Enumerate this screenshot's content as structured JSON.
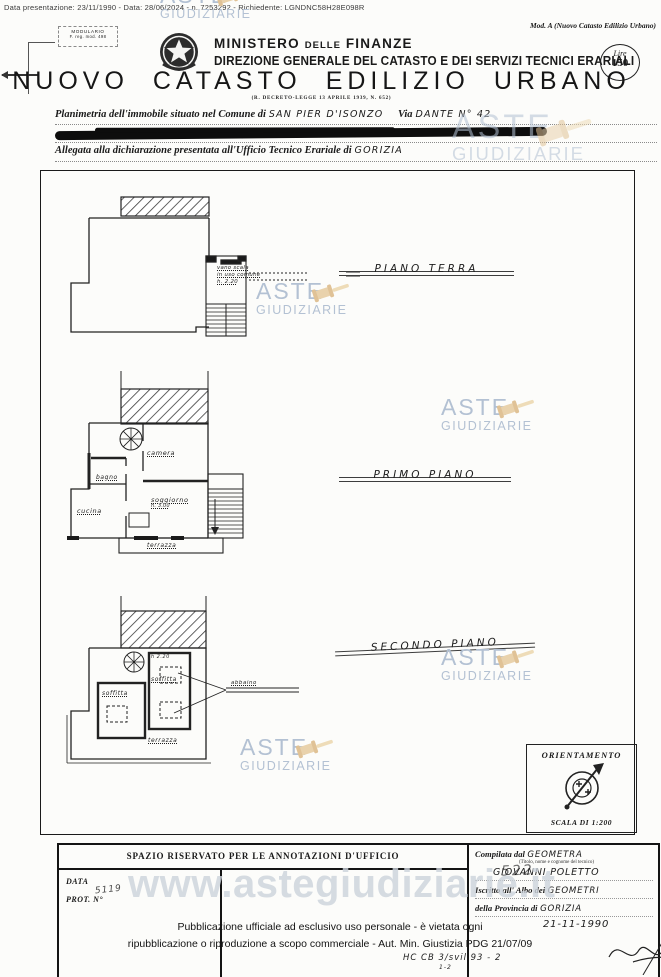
{
  "page": {
    "meta_line": "Data presentazione: 23/11/1990 - Data: 28/06/2024 - n. 7253292 - Richiedente: LGNDNC58H28E098R",
    "mod_ref": "Mod. A (Nuovo Catasto Edilizio Urbano)",
    "modulario": {
      "line1": "MODULARIO",
      "line2": "F. reg. mod. 498"
    },
    "ministry_1": "MINISTERO",
    "ministry_2": "DELLE",
    "ministry_3": "FINANZE",
    "directorate": "DIREZIONE GENERALE DEL CATASTO E DEI SERVIZI TECNICI ERARIALI",
    "stamp": {
      "currency": "Lire",
      "amount": "150"
    },
    "title": "NUOVO CATASTO EDILIZIO URBANO",
    "law_ref": "(R. DECRETO-LEGGE 13 APRILE 1939, N. 652)"
  },
  "form": {
    "field1_label": "Planimetria dell'immobile situato nel Comune di",
    "field1_value": "San Pier d'Isonzo",
    "field1b_label": "Via",
    "field1b_value": "Dante n° 42",
    "field3_label": "Allegata alla dichiarazione presentata all'Ufficio Tecnico Erariale di",
    "field3_value": "Gorizia"
  },
  "plans": {
    "ground": {
      "label": "PIANO TERRA",
      "note1": "vano scala",
      "note2": "in uso comune",
      "note3": "h. 2.20"
    },
    "first": {
      "label": "PRIMO PIANO",
      "camera": "camera",
      "bagno": "bagno",
      "cucina": "cucina",
      "soggiorno": "soggiorno",
      "soggiorno_h": "h. 3.00",
      "terrazza": "terrazza"
    },
    "second": {
      "label": "SECONDO PIANO",
      "soffitta1": "soffitta",
      "soffitta2": "soffitta",
      "h_note": "h 2.20",
      "abbaino": "abbaino",
      "terrazza": "terrazza"
    },
    "sheet_number": "522",
    "code_note": "HC CB 3/svil 93 - 2",
    "code_note_sub": "1-2",
    "orientation": {
      "title": "ORIENTAMENTO",
      "scale": "SCALA DI 1:200"
    }
  },
  "footer": {
    "annotations_header": "SPAZIO RISERVATO PER LE ANNOTAZIONI D'UFFICIO",
    "data_label": "DATA",
    "prot_label": "PROT. N°",
    "prot_value": "5119",
    "compiled_label": "Compilata dal",
    "compiled_value": "GEOMETRA",
    "compiled_hint": "(Titolo, nome e cognome del tecnico)",
    "technician_name": "GIOVANNI POLETTO",
    "albo_label": "Iscritto all' Albo dei",
    "albo_value": "GEOMETRI",
    "province_label": "della Provincia di",
    "province_value": "GORIZIA",
    "date_value": "21-11-1990"
  },
  "watermarks": {
    "aste_line1": "ASTE",
    "aste_line2": "GIUDIZIARIE",
    "site_url": "www.astegiudiziarie.it"
  },
  "legal": {
    "line1": "Pubblicazione ufficiale ad esclusivo uso personale - è vietata ogni",
    "line2": "ripubblicazione o riproduzione a scopo commerciale - Aut. Min. Giustizia PDG 21/07/09"
  },
  "colors": {
    "watermark_text": "#b3c1d3",
    "gavel": "#e8d2ab",
    "ink": "#1a1a1a",
    "paper": "#fcfcfa"
  }
}
